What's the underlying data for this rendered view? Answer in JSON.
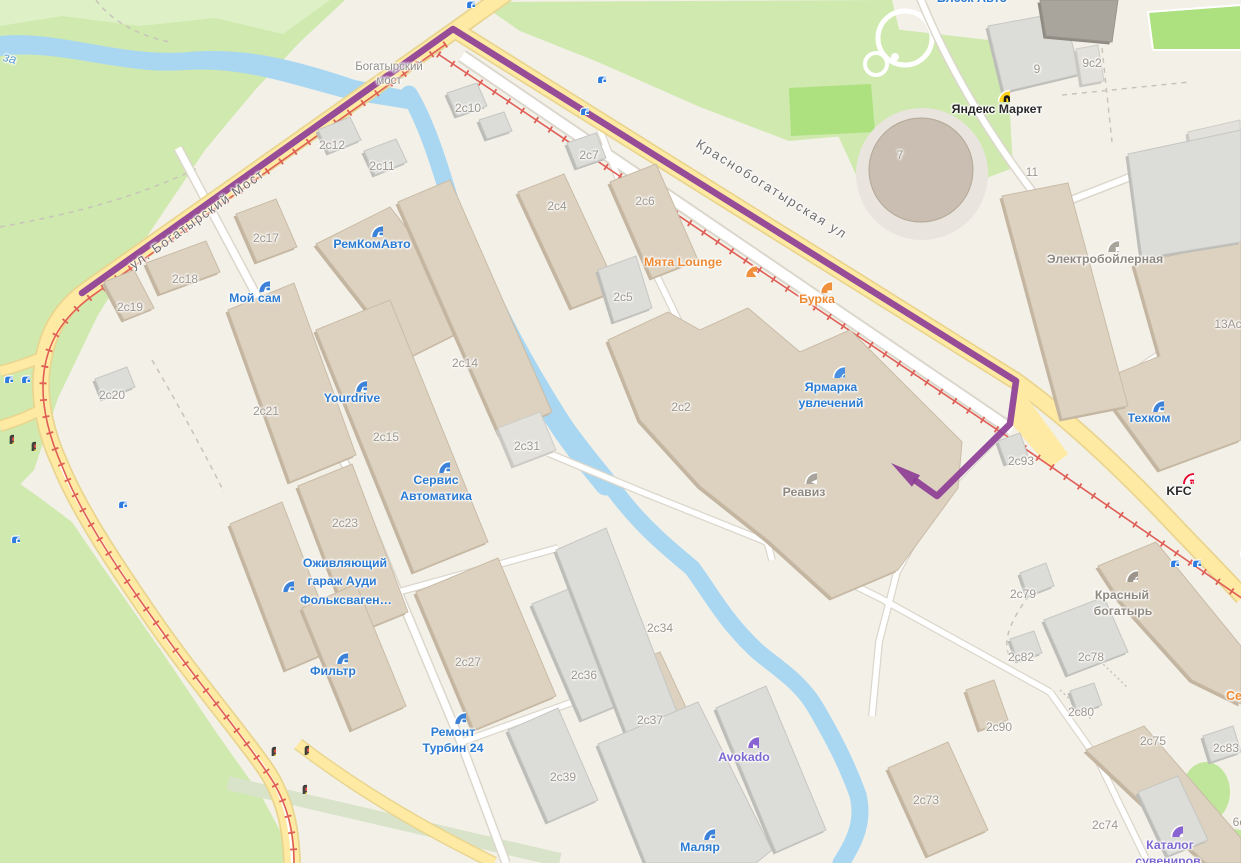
{
  "map_title": "Industrial district map with tram route (Krasnobogatyrskaya area)",
  "colors": {
    "route": "#8d3e96",
    "road_main": "#ffeaa4",
    "road_casing": "#e9d58f",
    "water": "#a9d7f1",
    "park": "#cfe9ae",
    "field": "#ade07f",
    "building_tan": "#ddd2c0",
    "building_grey": "#dcdcd9",
    "tram_line": "#df5e56",
    "tram_stop": "#2e7cdf"
  },
  "route": {
    "color": "#8d3e96",
    "width": 6.5,
    "points": [
      [
        82,
        293
      ],
      [
        453,
        29
      ],
      [
        1016,
        381
      ],
      [
        1010,
        424
      ],
      [
        937,
        496
      ],
      [
        916,
        481
      ]
    ],
    "arrow_tip": [
      891,
      463
    ]
  },
  "building_labels": [
    {
      "text": "2с10",
      "x": 468,
      "y": 108
    },
    {
      "text": "2с12",
      "x": 332,
      "y": 145
    },
    {
      "text": "2с11",
      "x": 382,
      "y": 166
    },
    {
      "text": "2с17",
      "x": 266,
      "y": 238
    },
    {
      "text": "2с18",
      "x": 185,
      "y": 279
    },
    {
      "text": "2с19",
      "x": 130,
      "y": 307
    },
    {
      "text": "2с14",
      "x": 465,
      "y": 363
    },
    {
      "text": "2с20",
      "x": 112,
      "y": 395
    },
    {
      "text": "2с21",
      "x": 266,
      "y": 411
    },
    {
      "text": "2с15",
      "x": 386,
      "y": 437
    },
    {
      "text": "2с31",
      "x": 527,
      "y": 446
    },
    {
      "text": "2с23",
      "x": 345,
      "y": 523
    },
    {
      "text": "2с4",
      "x": 557,
      "y": 206
    },
    {
      "text": "2с7",
      "x": 589,
      "y": 155
    },
    {
      "text": "2с6",
      "x": 645,
      "y": 201
    },
    {
      "text": "2с5",
      "x": 623,
      "y": 297
    },
    {
      "text": "2с2",
      "x": 681,
      "y": 407
    },
    {
      "text": "2с34",
      "x": 660,
      "y": 628
    },
    {
      "text": "2с36",
      "x": 584,
      "y": 675
    },
    {
      "text": "2с27",
      "x": 468,
      "y": 662
    },
    {
      "text": "2с37",
      "x": 650,
      "y": 720
    },
    {
      "text": "2с39",
      "x": 563,
      "y": 777
    },
    {
      "text": "2с73",
      "x": 926,
      "y": 800
    },
    {
      "text": "2с74",
      "x": 1105,
      "y": 825
    },
    {
      "text": "2с75",
      "x": 1153,
      "y": 741
    },
    {
      "text": "2с78",
      "x": 1091,
      "y": 657
    },
    {
      "text": "2с79",
      "x": 1023,
      "y": 594
    },
    {
      "text": "2с80",
      "x": 1081,
      "y": 712
    },
    {
      "text": "2с82",
      "x": 1021,
      "y": 657
    },
    {
      "text": "2с83",
      "x": 1226,
      "y": 748
    },
    {
      "text": "2с90",
      "x": 999,
      "y": 727
    },
    {
      "text": "2с93",
      "x": 1021,
      "y": 461
    },
    {
      "text": "9",
      "x": 1037,
      "y": 69
    },
    {
      "text": "9с2",
      "x": 1092,
      "y": 63
    },
    {
      "text": "7",
      "x": 900,
      "y": 155
    },
    {
      "text": "11",
      "x": 1032,
      "y": 172
    }
  ],
  "pois": [
    {
      "id": "remkomavto",
      "icon": "car-icon",
      "color": "blue",
      "icon_x": 368,
      "icon_y": 222,
      "lines": [
        {
          "text": "РемКомАвто",
          "x": 372,
          "y": 244
        }
      ]
    },
    {
      "id": "moy-sam",
      "icon": "car-icon",
      "color": "blue",
      "icon_x": 255,
      "icon_y": 277,
      "lines": [
        {
          "text": "Мой сам",
          "x": 255,
          "y": 298
        }
      ]
    },
    {
      "id": "yourdrive",
      "icon": "car-icon",
      "color": "blue",
      "icon_x": 352,
      "icon_y": 377,
      "lines": [
        {
          "text": "Yourdrive",
          "x": 352,
          "y": 398
        }
      ]
    },
    {
      "id": "servis-avtomatika",
      "icon": "car-icon",
      "color": "blue",
      "icon_x": 435,
      "icon_y": 458,
      "lines": [
        {
          "text": "Сервис",
          "x": 436,
          "y": 480
        },
        {
          "text": "Автоматика",
          "x": 436,
          "y": 496
        }
      ]
    },
    {
      "id": "ozhivlyayushchiy-garazh",
      "icon": "car-icon",
      "color": "blue",
      "icon_x": 279,
      "icon_y": 577,
      "lines": [
        {
          "text": "Оживляющий",
          "x": 345,
          "y": 563
        },
        {
          "text": "гараж Ауди",
          "x": 342,
          "y": 581
        },
        {
          "text": "Фольксваген…",
          "x": 346,
          "y": 600
        }
      ]
    },
    {
      "id": "filtr",
      "icon": "car-icon",
      "color": "blue",
      "icon_x": 333,
      "icon_y": 649,
      "lines": [
        {
          "text": "Фильтр",
          "x": 333,
          "y": 671
        }
      ]
    },
    {
      "id": "remont-turbin-24",
      "icon": "car-icon",
      "color": "blue",
      "icon_x": 451,
      "icon_y": 709,
      "lines": [
        {
          "text": "Ремонт",
          "x": 453,
          "y": 732
        },
        {
          "text": "Турбин 24",
          "x": 453,
          "y": 748
        }
      ]
    },
    {
      "id": "malyar",
      "icon": "car-icon",
      "color": "blue",
      "icon_x": 700,
      "icon_y": 825,
      "lines": [
        {
          "text": "Маляр",
          "x": 700,
          "y": 847
        }
      ]
    },
    {
      "id": "tehkom",
      "icon": "car-icon",
      "color": "blue",
      "icon_x": 1149,
      "icon_y": 397,
      "lines": [
        {
          "text": "Техком",
          "x": 1149,
          "y": 418
        }
      ]
    },
    {
      "id": "myata-lounge",
      "icon": "cocktail-icon",
      "color": "orange",
      "icon_x": 742,
      "icon_y": 262,
      "lines": [
        {
          "text": "Мята Lounge",
          "x": 683,
          "y": 262
        }
      ]
    },
    {
      "id": "burka",
      "icon": "coffee-icon",
      "color": "orange",
      "icon_x": 817,
      "icon_y": 278,
      "lines": [
        {
          "text": "Бурка",
          "x": 817,
          "y": 299
        }
      ]
    },
    {
      "id": "yarmarka-uvlecheniy",
      "icon": "basket-icon",
      "color": "blue",
      "icon_x": 830,
      "icon_y": 363,
      "lines": [
        {
          "text": "Ярмарка",
          "x": 831,
          "y": 387
        },
        {
          "text": "увлечений",
          "x": 831,
          "y": 403
        }
      ]
    },
    {
      "id": "reaviz",
      "icon": "graduation-icon",
      "color": "grey",
      "icon_x": 802,
      "icon_y": 469,
      "lines": [
        {
          "text": "Реавиз",
          "x": 804,
          "y": 492
        }
      ]
    },
    {
      "id": "avokado",
      "icon": "bed-icon",
      "color": "purple",
      "icon_x": 744,
      "icon_y": 733,
      "lines": [
        {
          "text": "Avokado",
          "x": 744,
          "y": 757
        }
      ]
    },
    {
      "id": "yandex-market",
      "icon": "yandex-market-icon",
      "color": "black",
      "icon_x": 995,
      "icon_y": 87,
      "lines": [
        {
          "text": "Яндекс Маркет",
          "x": 997,
          "y": 109
        }
      ]
    },
    {
      "id": "elektroboylernaya",
      "icon": "flag-icon",
      "color": "grey",
      "icon_x": 1104,
      "icon_y": 237,
      "lines": [
        {
          "text": "Электробойлерная",
          "x": 1105,
          "y": 259
        }
      ]
    },
    {
      "id": "kfc",
      "icon": "kfc-icon",
      "color": "black",
      "icon_x": 1179,
      "icon_y": 469,
      "lines": [
        {
          "text": "KFC",
          "x": 1179,
          "y": 491
        }
      ]
    },
    {
      "id": "krasny-bogatyr",
      "icon": "briefcase-icon",
      "color": "grey",
      "icon_x": 1123,
      "icon_y": 567,
      "lines": [
        {
          "text": "Красный",
          "x": 1122,
          "y": 595
        },
        {
          "text": "богатырь",
          "x": 1123,
          "y": 611
        }
      ]
    },
    {
      "id": "katalog-suvenirov",
      "icon": "dot-icon",
      "color": "purple",
      "icon_x": 1168,
      "icon_y": 822,
      "lines": [
        {
          "text": "Каталог",
          "x": 1170,
          "y": 845
        },
        {
          "text": "сувениров",
          "x": 1168,
          "y": 861
        }
      ]
    }
  ],
  "misc_labels": [
    {
      "name": "street-bogatyrsky-most",
      "text": "ул. Богатырский Мост",
      "x": 197,
      "y": 219,
      "color": "#6d6d6d",
      "size": 13,
      "rot": -35.5,
      "ls": 1.5
    },
    {
      "name": "street-krasnobogatyrskaya",
      "text": "Краснобогатырская ул",
      "x": 772,
      "y": 189,
      "color": "#6d6d6d",
      "size": 13,
      "rot": 32,
      "ls": 2
    },
    {
      "name": "bridge-label-line1",
      "text": "Богатырский",
      "x": 389,
      "y": 67,
      "color": "#8e8e8a",
      "size": 11.5
    },
    {
      "name": "bridge-label-line2",
      "text": "мост",
      "x": 389,
      "y": 81,
      "color": "#8e8e8a",
      "size": 11.5
    },
    {
      "name": "river-label-partial",
      "text": "за",
      "x": 10,
      "y": 58,
      "color": "#64a0d6",
      "size": 13,
      "rot": 14,
      "italic": true
    },
    {
      "name": "poi-blesk-avto-partial",
      "text": "Блеск Авто",
      "x": 972,
      "y": -2,
      "color": "#2b7bd2",
      "size": 12.5,
      "bold": true
    },
    {
      "name": "label-13a-partial",
      "text": "13Ас",
      "x": 1228,
      "y": 324,
      "color": "#9c968c",
      "size": 12
    },
    {
      "name": "label-6s-partial",
      "text": "6с",
      "x": 1239,
      "y": 822,
      "color": "#9c968c",
      "size": 12
    },
    {
      "name": "poi-se-partial",
      "text": "Се",
      "x": 1234,
      "y": 696,
      "color": "#ee8a33",
      "size": 12.5,
      "bold": true
    }
  ],
  "transit": {
    "tram_stops": [
      [
        464,
        -2
      ],
      [
        595,
        73
      ],
      [
        578,
        105
      ],
      [
        2,
        373
      ],
      [
        19,
        373
      ],
      [
        116,
        498
      ],
      [
        9,
        533
      ],
      [
        1168,
        557
      ],
      [
        1190,
        557
      ],
      [
        1238,
        547
      ]
    ],
    "traffic_lights": [
      [
        7,
        433
      ],
      [
        29,
        440
      ],
      [
        269,
        745
      ],
      [
        302,
        744
      ],
      [
        300,
        783
      ]
    ]
  }
}
